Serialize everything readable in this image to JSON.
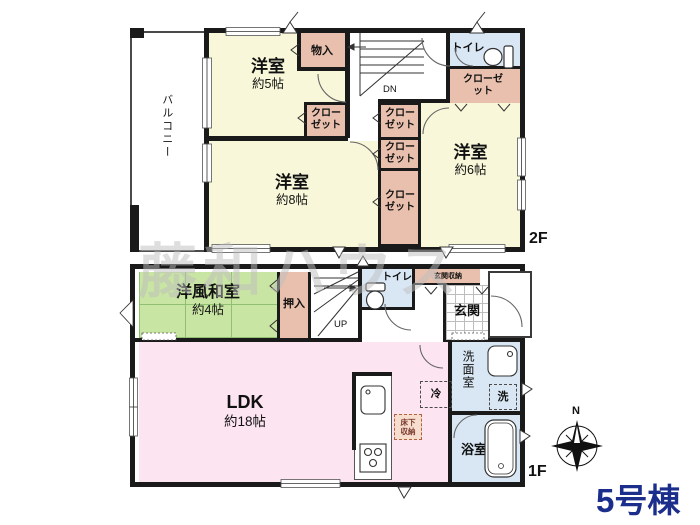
{
  "watermark": "藤和ハウス",
  "building_label": "5号棟",
  "compass": {
    "north": "N"
  },
  "colors": {
    "wall": "#1a1a1a",
    "room_cream": "#f8f7d9",
    "closet_pink": "#e8c0ad",
    "wet_area_blue": "#d9e7f4",
    "tatami_green": "#c8e5a3",
    "ldk_pink": "#fce4f0",
    "building_label_navy": "#1c2e8c"
  },
  "floor2": {
    "label": "2F",
    "balcony": "バルコニー",
    "room_5": {
      "name": "洋室",
      "size": "約5帖"
    },
    "room_8": {
      "name": "洋室",
      "size": "約8帖"
    },
    "room_6": {
      "name": "洋室",
      "size": "約6帖"
    },
    "storage": "物入",
    "closet": "クローゼット",
    "toilet": "トイレ",
    "stairs_down": "DN"
  },
  "floor1": {
    "label": "1F",
    "washitsu": {
      "name": "洋風和室",
      "size": "約4帖"
    },
    "oshiire": "押入",
    "stairs_up": "UP",
    "toilet": "トイレ",
    "entrance_storage": "玄関収納",
    "entrance": "玄関",
    "ldk": {
      "name": "LDK",
      "size": "約18帖"
    },
    "fridge": "冷",
    "underfloor_storage": "床下収納",
    "washroom": "洗面室",
    "washer": "洗",
    "bath": "浴室"
  }
}
